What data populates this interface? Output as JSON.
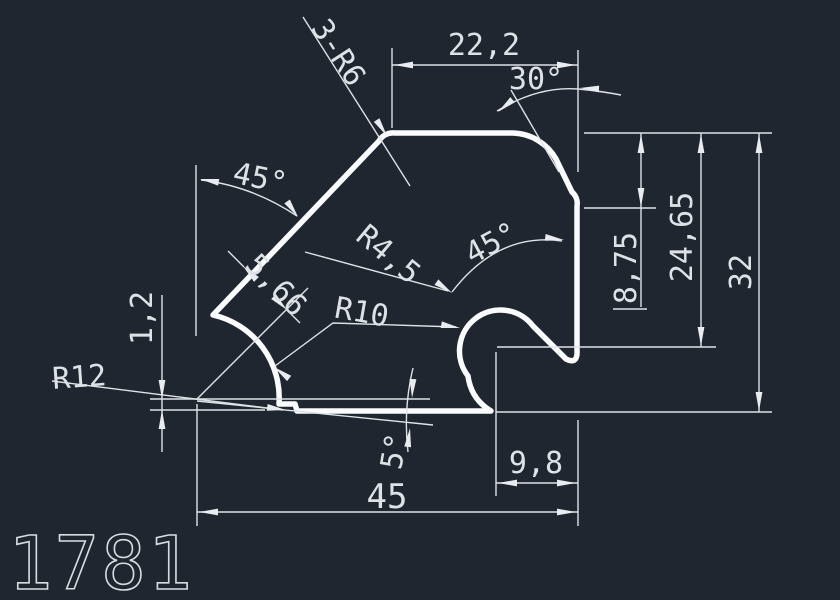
{
  "drawing": {
    "part_number": "1781",
    "colors": {
      "background": "#20262f",
      "profile_line": "#fafbfd",
      "dimension_line": "#dde2e7"
    },
    "labels": {
      "top_width": "22,2",
      "top_angle": "30°",
      "corner_radius_note": "3-R6",
      "left_angle": "45°",
      "offset_dim": "5,66",
      "slot_radius": "R4,5",
      "slot_angle": "45°",
      "fillet_radius": "R10",
      "left_radius": "R12",
      "step_height": "1,2",
      "right_depth_1": "8,75",
      "right_depth_2": "24,65",
      "right_depth_3": "32",
      "slot_offset": "9,8",
      "total_width": "45",
      "bottom_angle": "5°"
    }
  }
}
